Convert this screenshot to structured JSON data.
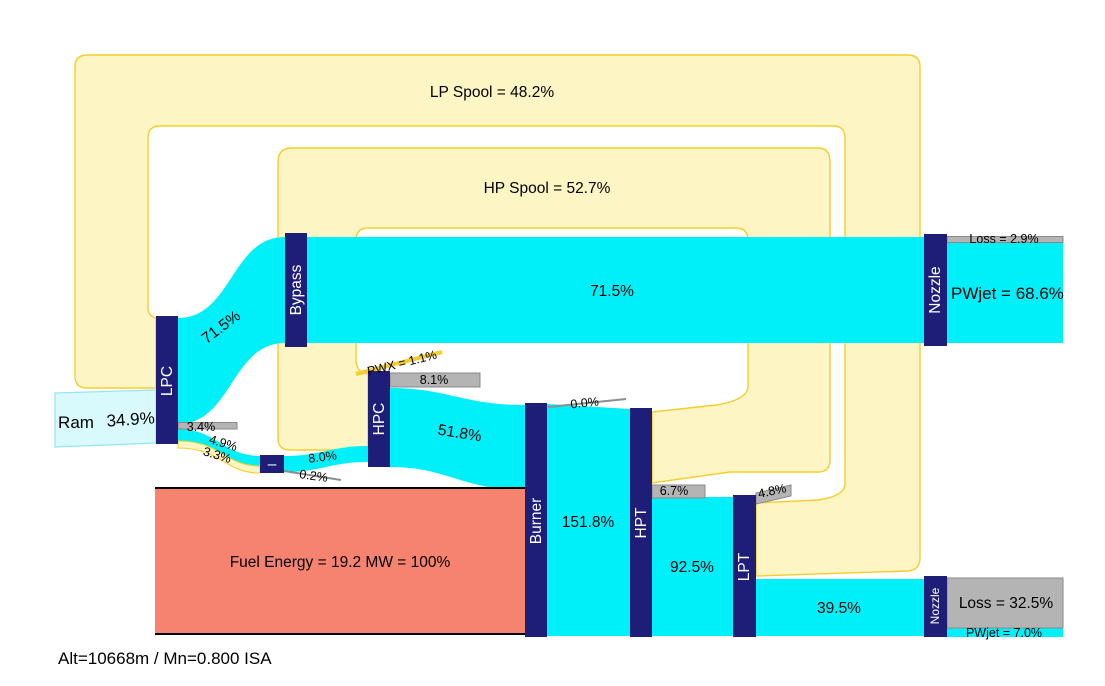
{
  "caption": "Alt=10668m / Mn=0.800 ISA",
  "colors": {
    "flow_cyan": "#00F0FA",
    "ram_pale_cyan": "#D8FAFD",
    "node_navy": "#1E1E78",
    "spool_band_fill": "#FDF5C4",
    "spool_band_border": "#F5CE2E",
    "loss_gray": "#B4B4B4",
    "fuel_salmon": "#F6836F"
  },
  "labels": {
    "lp_spool": "LP Spool = 48.2%",
    "hp_spool": "HP Spool = 52.7%",
    "ram": "Ram",
    "ram_value": "34.9%",
    "lpc": "LPC",
    "bypass": "Bypass",
    "hpc": "HPC",
    "burner": "Burner",
    "hpt": "HPT",
    "lpt": "LPT",
    "nozzle_top": "Nozzle",
    "nozzle_bottom": "Nozzle",
    "junction": "–",
    "flow_lpc_bypass": "71.5%",
    "flow_bypass_nozzle": "71.5%",
    "loss_lpc": "3.4%",
    "flow_49": "4.9%",
    "flow_33": "3.3%",
    "flow_80": "8.0%",
    "loss_02": "0.2%",
    "pwx": "PWX = 1.1%",
    "loss_81": "8.1%",
    "flow_518": "51.8%",
    "fuel": "Fuel Energy = 19.2 MW = 100%",
    "flow_1518": "151.8%",
    "loss_00": "0.0%",
    "loss_67": "6.7%",
    "flow_925": "92.5%",
    "loss_48": "4.8%",
    "flow_395": "39.5%",
    "loss_nozzle_top": "Loss = 2.9%",
    "pwjet_top": "PWjet = 68.6%",
    "loss_nozzle_bottom": "Loss = 32.5%",
    "pwjet_bottom": "PWjet = 7.0%"
  },
  "chart_data": {
    "type": "sankey",
    "title": "Turbofan engine energy flow (% of fuel energy)",
    "operating_point": "Alt=10668m / Mn=0.800 ISA",
    "fuel_energy_total": "19.2 MW = 100%",
    "nodes": [
      "Ram",
      "LPC",
      "Bypass",
      "Junction",
      "HPC",
      "Burner",
      "Fuel",
      "HPT",
      "LPT",
      "Nozzle (bypass)",
      "Nozzle (core)",
      "LP Spool",
      "HP Spool"
    ],
    "links": [
      {
        "source": "Ram",
        "target": "LPC",
        "value": 34.9,
        "kind": "air"
      },
      {
        "source": "LP Spool",
        "target": "LPC",
        "value": 48.2,
        "kind": "shaft"
      },
      {
        "source": "LPC",
        "target": "Bypass",
        "value": 71.5,
        "kind": "air"
      },
      {
        "source": "LPC",
        "target": "Loss",
        "value": 3.4,
        "kind": "loss"
      },
      {
        "source": "LPC",
        "target": "Junction",
        "value": 4.9,
        "kind": "air"
      },
      {
        "source": "LPC",
        "target": "Junction",
        "value": 3.3,
        "kind": "shaft"
      },
      {
        "source": "Junction",
        "target": "HPC",
        "value": 8.0,
        "kind": "air"
      },
      {
        "source": "Junction",
        "target": "Loss",
        "value": 0.2,
        "kind": "loss"
      },
      {
        "source": "HP Spool",
        "target": "HPC",
        "value": 52.7,
        "kind": "shaft"
      },
      {
        "source": "HPC",
        "target": "PWX",
        "value": 1.1,
        "kind": "shaft"
      },
      {
        "source": "HPC",
        "target": "Loss",
        "value": 8.1,
        "kind": "loss"
      },
      {
        "source": "HPC",
        "target": "Burner",
        "value": 51.8,
        "kind": "air"
      },
      {
        "source": "Fuel",
        "target": "Burner",
        "value": 100.0,
        "kind": "fuel"
      },
      {
        "source": "Burner",
        "target": "Loss",
        "value": 0.0,
        "kind": "loss"
      },
      {
        "source": "Burner",
        "target": "HPT",
        "value": 151.8,
        "kind": "gas"
      },
      {
        "source": "HPT",
        "target": "HP Spool",
        "value": 52.7,
        "kind": "shaft"
      },
      {
        "source": "HPT",
        "target": "Loss",
        "value": 6.7,
        "kind": "loss"
      },
      {
        "source": "HPT",
        "target": "LPT",
        "value": 92.5,
        "kind": "gas"
      },
      {
        "source": "LPT",
        "target": "LP Spool",
        "value": 48.2,
        "kind": "shaft"
      },
      {
        "source": "LPT",
        "target": "Loss",
        "value": 4.8,
        "kind": "loss"
      },
      {
        "source": "LPT",
        "target": "Nozzle (core)",
        "value": 39.5,
        "kind": "gas"
      },
      {
        "source": "Bypass",
        "target": "Nozzle (bypass)",
        "value": 71.5,
        "kind": "air"
      },
      {
        "source": "Nozzle (bypass)",
        "target": "Loss",
        "value": 2.9,
        "kind": "loss"
      },
      {
        "source": "Nozzle (bypass)",
        "target": "PWjet",
        "value": 68.6,
        "kind": "output"
      },
      {
        "source": "Nozzle (core)",
        "target": "Loss",
        "value": 32.5,
        "kind": "loss"
      },
      {
        "source": "Nozzle (core)",
        "target": "PWjet",
        "value": 7.0,
        "kind": "output"
      }
    ],
    "legend_position": "none",
    "grid": false
  }
}
